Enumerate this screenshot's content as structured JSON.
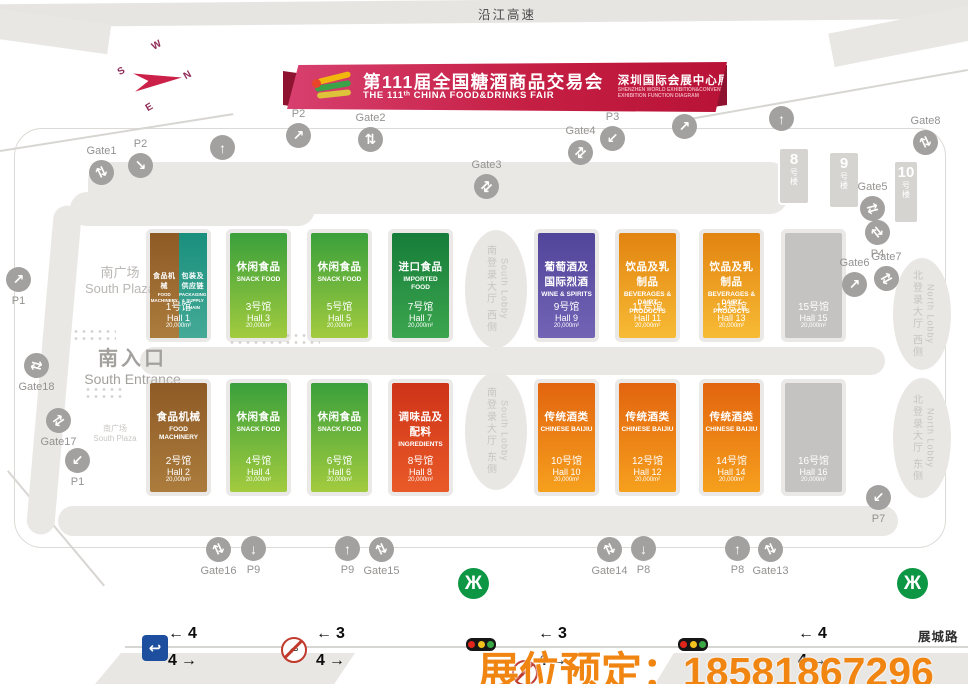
{
  "header": {
    "expressway": "沿江高速"
  },
  "banner": {
    "title_cn": "第111届全国糖酒商品交易会",
    "title_en": "THE 111ᵗʰ CHINA FOOD&DRINKS FAIR",
    "subtitle_cn": "深圳国际会展中心展区功能图",
    "subtitle_en1": "SHENZHEN WORLD EXHIBITION&CONVENTION CENTER",
    "subtitle_en2": "EXHIBITION FUNCTION DIAGRAM"
  },
  "compass": {
    "n": "N",
    "e": "E",
    "s": "S",
    "w": "W"
  },
  "areas": {
    "south_plaza": {
      "cn": "南广场",
      "en": "South Plaza"
    },
    "south_plaza_small": {
      "cn": "南广场",
      "en": "South Plaza"
    },
    "south_entrance": {
      "cn": "南入口",
      "en": "South Entrance"
    }
  },
  "lobbies": [
    {
      "cn": "南登录大厅 西侧",
      "en": "South Lobby",
      "x": 465,
      "y": 230,
      "w": 62,
      "h": 118
    },
    {
      "cn": "南登录大厅 东侧",
      "en": "South Lobby",
      "x": 465,
      "y": 372,
      "w": 62,
      "h": 118
    },
    {
      "cn": "北登录大厅 西侧",
      "en": "North Lobby",
      "x": 893,
      "y": 258,
      "w": 58,
      "h": 112
    },
    {
      "cn": "北登录大厅 东侧",
      "en": "North Lobby",
      "x": 893,
      "y": 378,
      "w": 58,
      "h": 120
    }
  ],
  "buildings": [
    {
      "num": "8",
      "suffix": "号楼",
      "x": 778,
      "y": 147,
      "w": 32,
      "h": 58
    },
    {
      "num": "9",
      "suffix": "号楼",
      "x": 828,
      "y": 151,
      "w": 32,
      "h": 58
    },
    {
      "num": "10",
      "suffix": "号楼",
      "x": 893,
      "y": 160,
      "w": 26,
      "h": 64
    }
  ],
  "halls": [
    {
      "num_cn": "1号馆",
      "num_en": "Hall 1",
      "area": "20,000m²",
      "row": 1,
      "col": 0,
      "segments": [
        {
          "cat_cn": "食品机械",
          "cat_en": "FOOD MACHINERY",
          "color": "machinery"
        },
        {
          "cat_cn": "包装及供应链",
          "cat_en": "PACKAGING & SUPPLY CHAIN",
          "color": "packaging"
        }
      ]
    },
    {
      "num_cn": "3号馆",
      "num_en": "Hall 3",
      "area": "20,000m²",
      "row": 1,
      "col": 1,
      "cat_cn": "休闲食品",
      "cat_en": "SNACK FOOD",
      "color": "snack"
    },
    {
      "num_cn": "5号馆",
      "num_en": "Hall 5",
      "area": "20,000m²",
      "row": 1,
      "col": 2,
      "cat_cn": "休闲食品",
      "cat_en": "SNACK FOOD",
      "color": "snack"
    },
    {
      "num_cn": "7号馆",
      "num_en": "Hall 7",
      "area": "20,000m²",
      "row": 1,
      "col": 3,
      "cat_cn": "进口食品",
      "cat_en": "IMPORTED FOOD",
      "color": "imported"
    },
    {
      "num_cn": "9号馆",
      "num_en": "Hall 9",
      "area": "20,000m²",
      "row": 1,
      "col": 4,
      "cat_cn": "葡萄酒及国际烈酒",
      "cat_en": "WINE & SPIRITS",
      "color": "wine"
    },
    {
      "num_cn": "11号馆",
      "num_en": "Hall 11",
      "area": "20,000m²",
      "row": 1,
      "col": 5,
      "cat_cn": "饮品及乳制品",
      "cat_en": "BEVERAGES & DAIRT PRODUCTS",
      "color": "beverage"
    },
    {
      "num_cn": "13号馆",
      "num_en": "Hall 13",
      "area": "20,000m²",
      "row": 1,
      "col": 6,
      "cat_cn": "饮品及乳制品",
      "cat_en": "BEVERAGES & DAIRT PRODUCTS",
      "color": "beverage"
    },
    {
      "num_cn": "15号馆",
      "num_en": "Hall 15",
      "area": "20,000m²",
      "row": 1,
      "col": 7,
      "cat_cn": "",
      "cat_en": "",
      "color": "empty"
    },
    {
      "num_cn": "2号馆",
      "num_en": "Hall 2",
      "area": "20,000m²",
      "row": 2,
      "col": 0,
      "cat_cn": "食品机械",
      "cat_en": "FOOD MACHINERY",
      "color": "machinery"
    },
    {
      "num_cn": "4号馆",
      "num_en": "Hall 4",
      "area": "20,000m²",
      "row": 2,
      "col": 1,
      "cat_cn": "休闲食品",
      "cat_en": "SNACK FOOD",
      "color": "snack"
    },
    {
      "num_cn": "6号馆",
      "num_en": "Hall 6",
      "area": "20,000m²",
      "row": 2,
      "col": 2,
      "cat_cn": "休闲食品",
      "cat_en": "SNACK FOOD",
      "color": "snack"
    },
    {
      "num_cn": "8号馆",
      "num_en": "Hall 8",
      "area": "20,000m²",
      "row": 2,
      "col": 3,
      "cat_cn": "调味品及配料",
      "cat_en": "INGREDIENTS",
      "color": "ingredients"
    },
    {
      "num_cn": "10号馆",
      "num_en": "Hall 10",
      "area": "20,000m²",
      "row": 2,
      "col": 4,
      "cat_cn": "传统酒类",
      "cat_en": "CHINESE BAIJIU",
      "color": "baijiu"
    },
    {
      "num_cn": "12号馆",
      "num_en": "Hall 12",
      "area": "20,000m²",
      "row": 2,
      "col": 5,
      "cat_cn": "传统酒类",
      "cat_en": "CHINESE BAIJIU",
      "color": "baijiu"
    },
    {
      "num_cn": "14号馆",
      "num_en": "Hall 14",
      "area": "20,000m²",
      "row": 2,
      "col": 6,
      "cat_cn": "传统酒类",
      "cat_en": "CHINESE BAIJIU",
      "color": "baijiu"
    },
    {
      "num_cn": "16号馆",
      "num_en": "Hall 16",
      "area": "20,000m²",
      "row": 2,
      "col": 7,
      "cat_cn": "",
      "cat_en": "",
      "color": "empty"
    }
  ],
  "markers": [
    {
      "label": "Gate1",
      "x": 101,
      "y": 172,
      "glyph": "⇅",
      "rot": -25,
      "lpos": "top"
    },
    {
      "label": "P2",
      "x": 140,
      "y": 165,
      "glyph": "↘",
      "rot": 0,
      "lpos": "top"
    },
    {
      "label": "",
      "x": 222,
      "y": 147,
      "glyph": "↑",
      "rot": 0,
      "lpos": "top"
    },
    {
      "label": "P2",
      "x": 298,
      "y": 135,
      "glyph": "↗",
      "rot": 0,
      "lpos": "top"
    },
    {
      "label": "Gate2",
      "x": 370,
      "y": 139,
      "glyph": "⇅",
      "rot": 0,
      "lpos": "top"
    },
    {
      "label": "Gate3",
      "x": 486,
      "y": 186,
      "glyph": "⇄",
      "rot": -45,
      "lpos": "top"
    },
    {
      "label": "Gate4",
      "x": 580,
      "y": 152,
      "glyph": "⇄",
      "rot": -45,
      "lpos": "top"
    },
    {
      "label": "P3",
      "x": 612,
      "y": 138,
      "glyph": "↙",
      "rot": 0,
      "lpos": "top"
    },
    {
      "label": "",
      "x": 684,
      "y": 126,
      "glyph": "↗",
      "rot": 0,
      "lpos": "top"
    },
    {
      "label": "",
      "x": 781,
      "y": 118,
      "glyph": "↑",
      "rot": 0,
      "lpos": "top"
    },
    {
      "label": "Gate8",
      "x": 925,
      "y": 142,
      "glyph": "⇅",
      "rot": -25,
      "lpos": "top"
    },
    {
      "label": "Gate5",
      "x": 872,
      "y": 208,
      "glyph": "⇄",
      "rot": -15,
      "lpos": "top"
    },
    {
      "label": "P4",
      "x": 877,
      "y": 232,
      "glyph": "⇅",
      "rot": -40,
      "lpos": "bottom"
    },
    {
      "label": "Gate6",
      "x": 854,
      "y": 284,
      "glyph": "↗",
      "rot": 0,
      "lpos": "top"
    },
    {
      "label": "Gate7",
      "x": 886,
      "y": 278,
      "glyph": "⇄",
      "rot": -30,
      "lpos": "top"
    },
    {
      "label": "Gate18",
      "x": 36,
      "y": 365,
      "glyph": "⇄",
      "rot": 15,
      "lpos": "bottom"
    },
    {
      "label": "Gate17",
      "x": 58,
      "y": 420,
      "glyph": "⇄",
      "rot": -35,
      "lpos": "bottom"
    },
    {
      "label": "P1",
      "x": 77,
      "y": 460,
      "glyph": "↙",
      "rot": 0,
      "lpos": "bottom"
    },
    {
      "label": "P1",
      "x": 18,
      "y": 279,
      "glyph": "↗",
      "rot": 0,
      "lpos": "bottom"
    },
    {
      "label": "Gate16",
      "x": 218,
      "y": 549,
      "glyph": "⇅",
      "rot": -25,
      "lpos": "bottom"
    },
    {
      "label": "P9",
      "x": 253,
      "y": 548,
      "glyph": "↓",
      "rot": 0,
      "lpos": "bottom"
    },
    {
      "label": "P9",
      "x": 347,
      "y": 548,
      "glyph": "↑",
      "rot": 0,
      "lpos": "bottom"
    },
    {
      "label": "Gate15",
      "x": 381,
      "y": 549,
      "glyph": "⇅",
      "rot": -25,
      "lpos": "bottom"
    },
    {
      "label": "Gate14",
      "x": 609,
      "y": 549,
      "glyph": "⇅",
      "rot": -25,
      "lpos": "bottom"
    },
    {
      "label": "P8",
      "x": 643,
      "y": 548,
      "glyph": "↓",
      "rot": 0,
      "lpos": "bottom"
    },
    {
      "label": "P8",
      "x": 737,
      "y": 548,
      "glyph": "↑",
      "rot": 0,
      "lpos": "bottom"
    },
    {
      "label": "Gate13",
      "x": 770,
      "y": 549,
      "glyph": "⇅",
      "rot": -25,
      "lpos": "bottom"
    },
    {
      "label": "P7",
      "x": 878,
      "y": 497,
      "glyph": "↙",
      "rot": 0,
      "lpos": "bottom"
    }
  ],
  "icons": {
    "metro": "Ж",
    "u_turn": "↩",
    "no_u_turn": "↩",
    "arrow_left": "←",
    "arrow_right": "→"
  },
  "road": {
    "name": "展城路",
    "groups": [
      {
        "left_num": "4",
        "right_num": "4",
        "x": 168
      },
      {
        "left_num": "3",
        "right_num": "4",
        "x": 316
      },
      {
        "left_num": "3",
        "right_num": "4",
        "x": 538
      },
      {
        "left_num": "4",
        "right_num": "4",
        "x": 798
      }
    ]
  },
  "overlay": {
    "text": "展位预定：18581867296",
    "color": "#f08511"
  },
  "traffic_light_colors": [
    "#e0251c",
    "#f2c11d",
    "#3aa845"
  ]
}
